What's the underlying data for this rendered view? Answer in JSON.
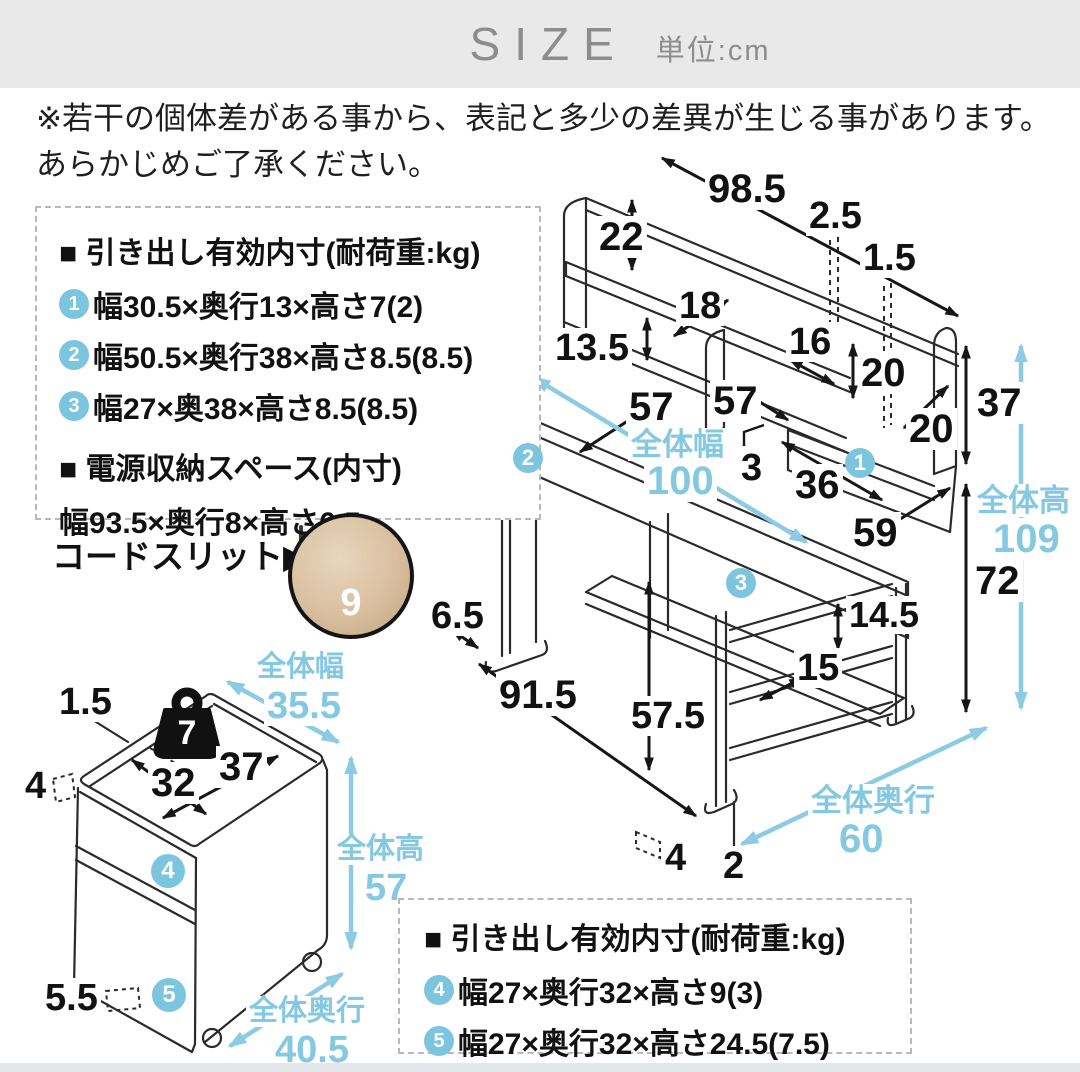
{
  "colors": {
    "accent_blue": "#85c8e2",
    "badge_blue": "#7cc5de",
    "header_bg": "#e9e9e9",
    "header_text": "#8d8d8d",
    "line_art": "#2a2a2a"
  },
  "header": {
    "title": "SIZE",
    "unit_label": "単位:cm"
  },
  "disclaimer": {
    "line1": "※若干の個体差がある事から、表記と多少の差異が生じる事があります。",
    "line2": "あらかじめご了承ください。"
  },
  "spec_box_top": {
    "heading": "■ 引き出し有効内寸(耐荷重:kg)",
    "items": [
      {
        "num": "1",
        "text": "幅30.5×奥行13×高さ7(2)"
      },
      {
        "num": "2",
        "text": "幅50.5×奥行38×高さ8.5(8.5)"
      },
      {
        "num": "3",
        "text": "幅27×奥38×高さ8.5(8.5)"
      }
    ],
    "sub_heading": "■ 電源収納スペース(内寸)",
    "sub_text": "幅93.5×奥行8×高さ6.5"
  },
  "cord_slit": {
    "label": "コードスリット▶",
    "width_value": "9"
  },
  "desk": {
    "labels": {
      "top_width": "98.5",
      "back_divider": "2.5",
      "right_divider": "1.5",
      "top_shelf_height": "22",
      "shelf_depth": "18",
      "shelf_height": "13.5",
      "compartment_width": "16",
      "compartment_height": "20",
      "compartment_depth": "20",
      "hutch_height": "37",
      "left_width": "57",
      "right_width": "57",
      "slot_gap": "3",
      "right_shelf_width": "36",
      "overall_width_label": "全体幅",
      "overall_width": "100",
      "desktop_depth": "59",
      "overall_height_label": "全体高",
      "overall_height": "109",
      "desk_height": "72",
      "shelf_gap_upper": "14.5",
      "shelf_gap_lower": "15",
      "overhang": "6.5",
      "inner_width": "91.5",
      "knee_clearance": "57.5",
      "foot_depth": "4",
      "foot_height": "2",
      "overall_depth_label": "全体奥行",
      "overall_depth": "60",
      "badge1": "1",
      "badge2": "2",
      "badge3": "3"
    }
  },
  "cabinet": {
    "labels": {
      "top_edge": "1.5",
      "load_capacity": "7",
      "side_gap": "4",
      "inner_depth": "32",
      "inner_width": "37",
      "overall_width_label": "全体幅",
      "overall_width": "35.5",
      "overall_height_label": "全体高",
      "overall_height": "57",
      "base_height": "5.5",
      "overall_depth_label": "全体奥行",
      "overall_depth": "40.5",
      "badge4": "4",
      "badge5": "5"
    }
  },
  "spec_box_bottom": {
    "heading": "■ 引き出し有効内寸(耐荷重:kg)",
    "items": [
      {
        "num": "4",
        "text": "幅27×奥行32×高さ9(3)"
      },
      {
        "num": "5",
        "text": "幅27×奥行32×高さ24.5(7.5)"
      }
    ]
  }
}
